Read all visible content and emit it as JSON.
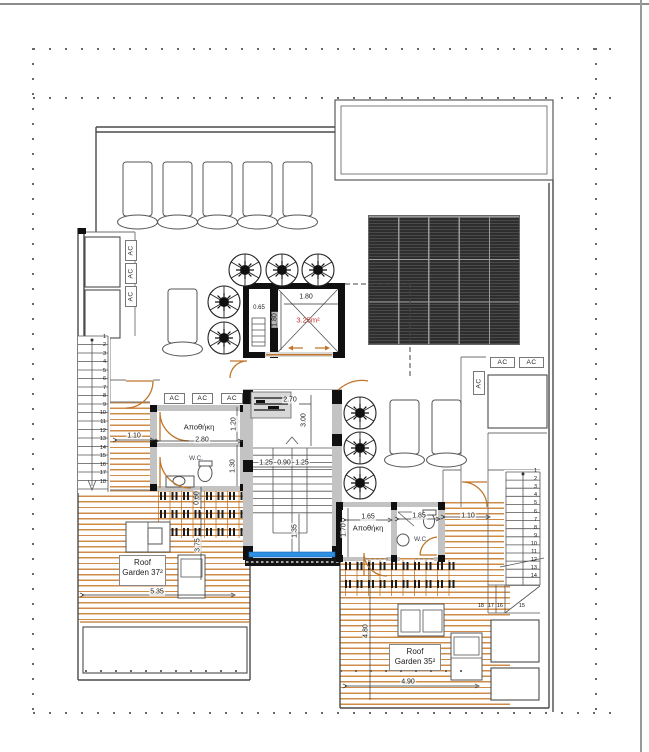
{
  "plan": {
    "ac_label": "AC",
    "labels": {
      "storage": "Αποθήκη",
      "wc": "W.C.",
      "roof": "Roof",
      "garden_left": "Garden 37²",
      "garden_right": "Garden 35²",
      "lift_area": "3.25m²"
    },
    "dims": {
      "left_door": "1.10",
      "storage_left_width": "2.80",
      "storage_left_depth": "1.20",
      "wc_left_depth": "1.30",
      "lift_width": "1.80",
      "lift_depth": "1.80",
      "shaft_width": "0.65",
      "stair_run": "2.70",
      "stair_total": "3.00",
      "stair_flight_a": "1.25",
      "stair_mid": "0.90",
      "stair_flight_b": "1.25",
      "stair_bottom": "1.35",
      "storage_right_width": "1.65",
      "storage_right_depth": "1.70",
      "wc_right_width": "1.85",
      "right_door": "1.10",
      "deck_left_width": "5.35",
      "pergola_depth": "0.60",
      "deck_left_depth": "3.75",
      "deck_right_depth": "4.80",
      "deck_right_width": "4.90"
    },
    "stairs": {
      "left": [
        "1",
        "2",
        "3",
        "4",
        "5",
        "6",
        "7",
        "8",
        "9",
        "10",
        "11",
        "12",
        "13",
        "14",
        "15",
        "16",
        "17",
        "18"
      ],
      "right": [
        "1",
        "2",
        "3",
        "4",
        "5",
        "6",
        "7",
        "8",
        "9",
        "10",
        "11",
        "12",
        "13",
        "14"
      ],
      "right_winders": [
        "18",
        "17",
        "16",
        "15"
      ]
    },
    "colors": {
      "deck_orange": "#cd8a43",
      "door_orange": "#bf762c",
      "glass_blue": "#2f8fe0",
      "area_red": "#c03028",
      "solar_dark": "#343434"
    }
  }
}
